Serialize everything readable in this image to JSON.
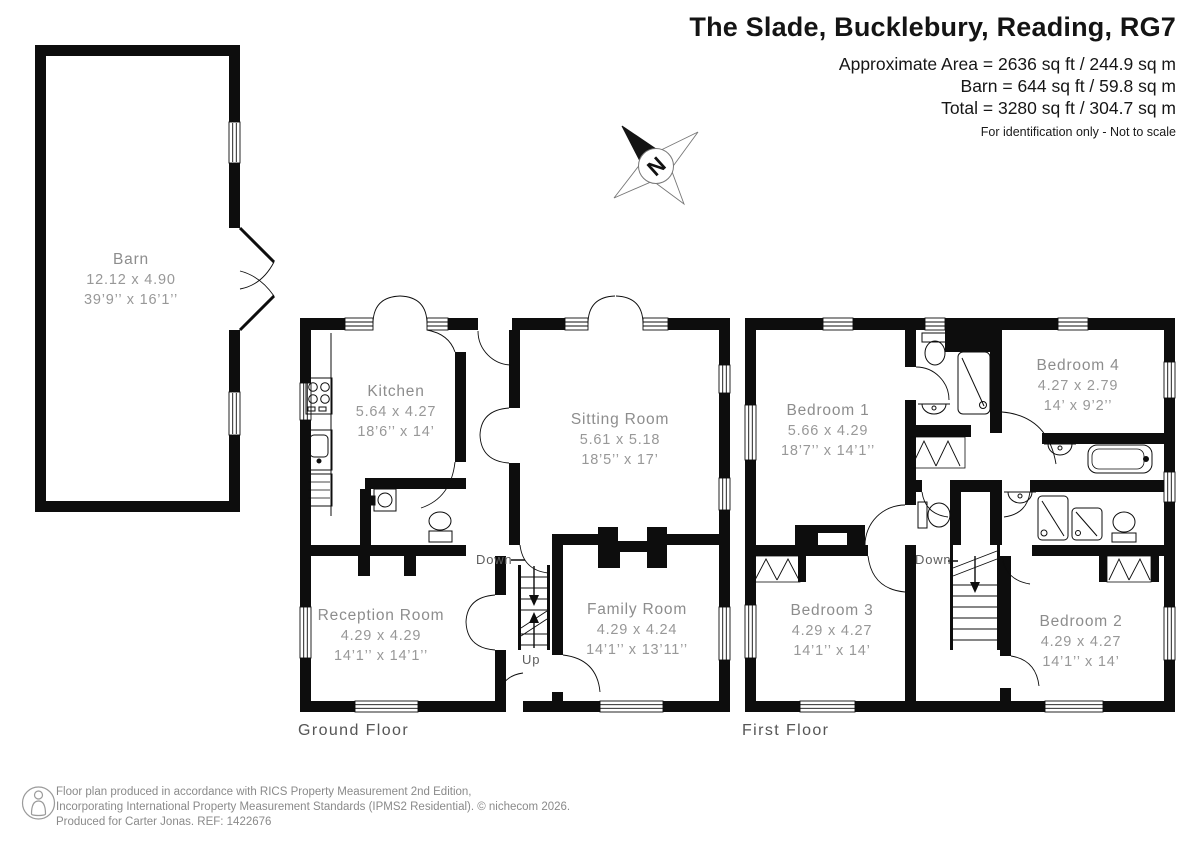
{
  "header": {
    "title": "The Slade, Bucklebury, Reading, RG7",
    "area_lines": [
      "Approximate Area = 2636 sq ft / 244.9 sq m",
      "Barn = 644 sq ft / 59.8 sq m",
      "Total = 3280 sq ft / 304.7 sq m"
    ],
    "note": "For identification only - Not to scale"
  },
  "compass": {
    "north_label": "N"
  },
  "floor_labels": {
    "ground": "Ground Floor",
    "first": "First Floor"
  },
  "stairs": {
    "ground_down": "Down",
    "ground_up": "Up",
    "first_down": "Down"
  },
  "rooms": [
    {
      "name": "Barn",
      "metric": "12.12 x 4.90",
      "imperial": "39’9’’ x 16’1’’"
    },
    {
      "name": "Kitchen",
      "metric": "5.64 x 4.27",
      "imperial": "18’6’’ x 14’"
    },
    {
      "name": "Sitting Room",
      "metric": "5.61 x 5.18",
      "imperial": "18’5’’ x 17’"
    },
    {
      "name": "Reception Room",
      "metric": "4.29 x 4.29",
      "imperial": "14’1’’ x 14’1’’"
    },
    {
      "name": "Family Room",
      "metric": "4.29 x 4.24",
      "imperial": "14’1’’ x 13’11’’"
    },
    {
      "name": "Bedroom 1",
      "metric": "5.66 x 4.29",
      "imperial": "18’7’’ x 14’1’’"
    },
    {
      "name": "Bedroom 4",
      "metric": "4.27 x 2.79",
      "imperial": "14’ x 9’2’’"
    },
    {
      "name": "Bedroom 3",
      "metric": "4.29 x 4.27",
      "imperial": "14’1’’ x 14’"
    },
    {
      "name": "Bedroom 2",
      "metric": "4.29 x 4.27",
      "imperial": "14’1’’ x 14’"
    }
  ],
  "footer": {
    "line1": "Floor plan produced in accordance with RICS Property Measurement 2nd Edition,",
    "line2": "Incorporating International Property Measurement Standards (IPMS2 Residential).    © nichecom 2026.",
    "line3": "Produced for Carter Jonas.   REF: 1422676"
  }
}
